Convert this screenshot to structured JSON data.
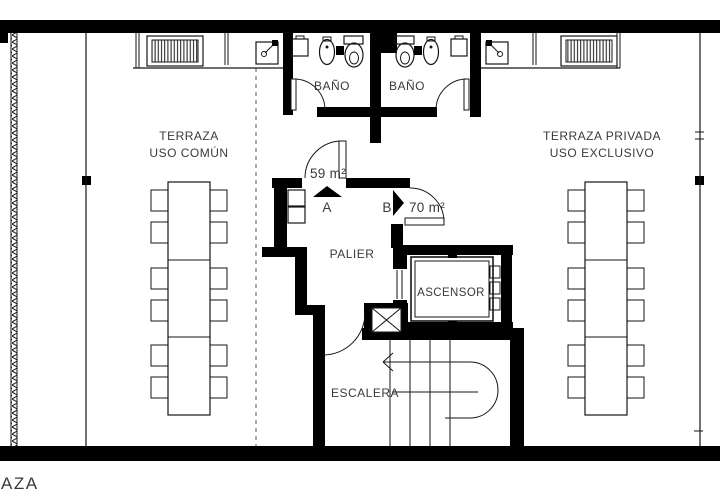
{
  "floor_plan": {
    "left_terrace": {
      "line1": "TERRAZA",
      "line2": "USO COMÚN"
    },
    "right_terrace": {
      "line1": "TERRAZA PRIVADA",
      "line2": "USO EXCLUSIVO"
    },
    "bathrooms": {
      "left": "BAÑO",
      "right": "BAÑO"
    },
    "units": {
      "a_label": "A",
      "a_area": "59 m²",
      "b_label": "B",
      "b_area": "70 m²"
    },
    "rooms": {
      "palier": "PALIER",
      "ascensor": "ASCENSOR",
      "escalera": "ESCALERA"
    },
    "bottom_text": "AZA",
    "colors": {
      "wall": "#000000",
      "line": "#1c1c1c",
      "text": "#3a3a3a",
      "background": "#ffffff"
    }
  }
}
